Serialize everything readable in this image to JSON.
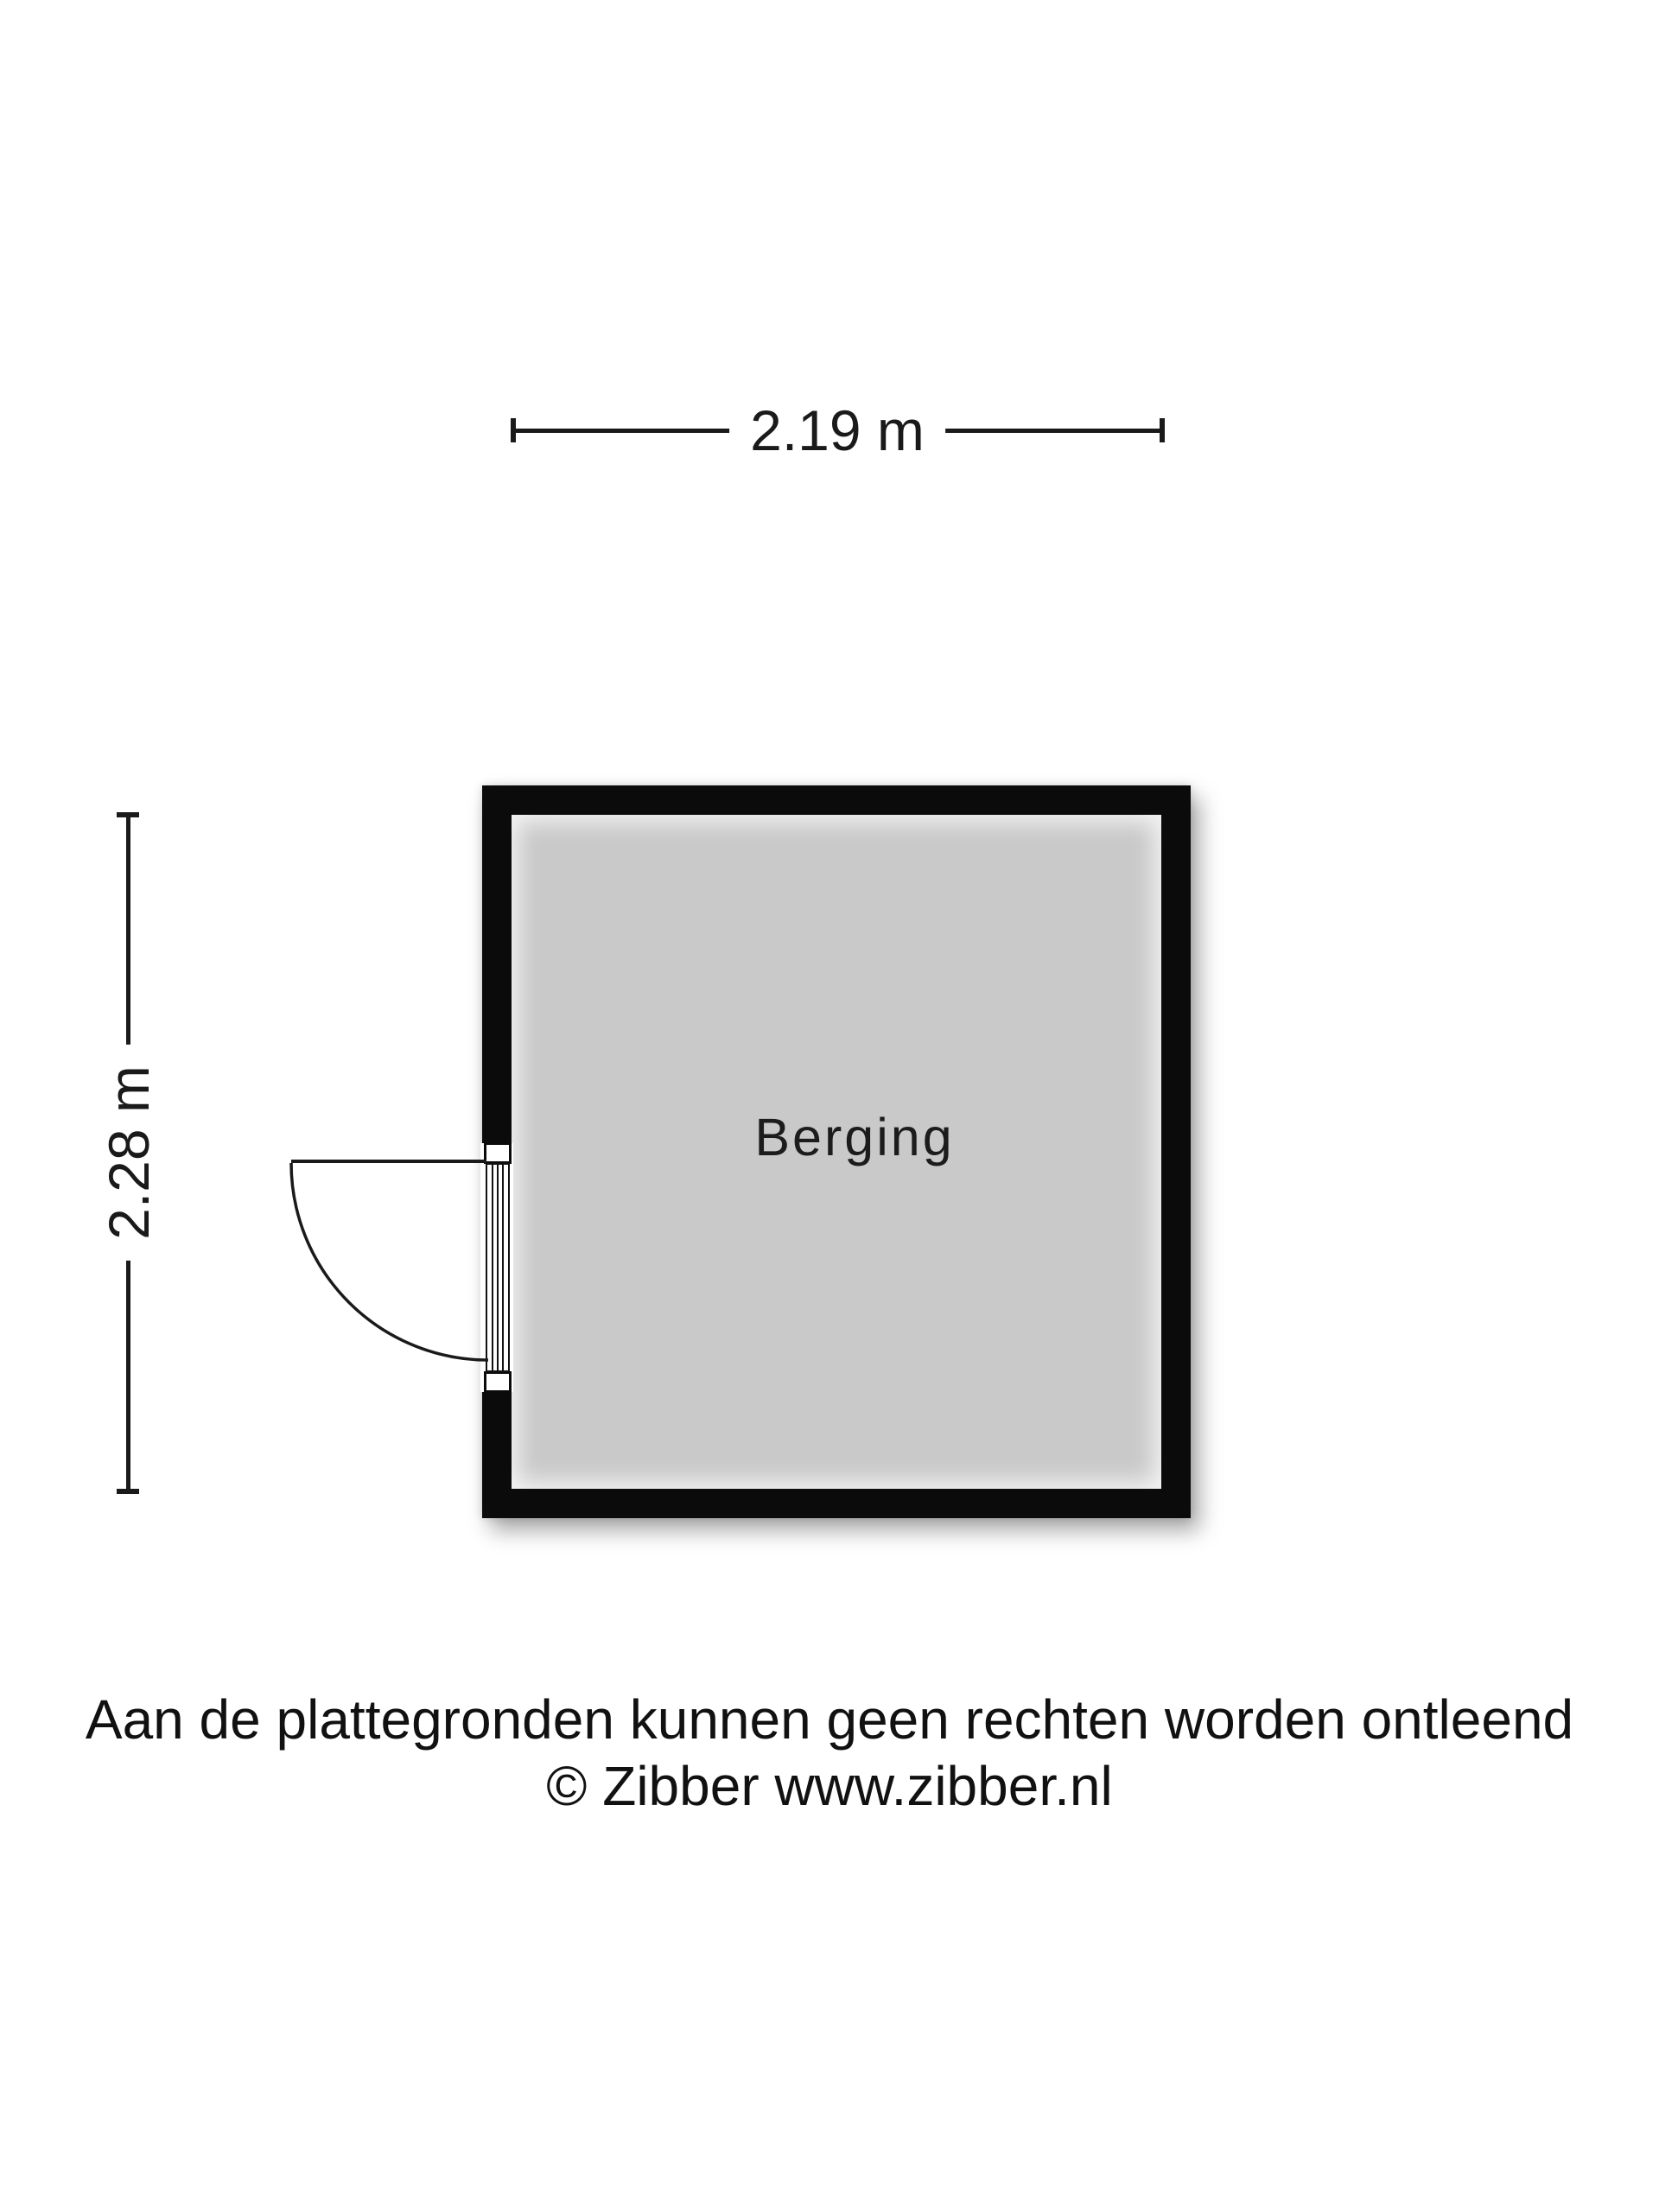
{
  "floorplan": {
    "room": {
      "label": "Berging"
    },
    "dimensions": {
      "width_label": "2.19 m",
      "height_label": "2.28 m"
    },
    "door": {
      "icon": "door-swing-icon",
      "type": "single-swing-door"
    },
    "colors": {
      "wall": "#0b0b0b",
      "floor": "#c9c9c9",
      "line": "#1a1a1a",
      "background": "#ffffff"
    }
  },
  "footer": {
    "disclaimer": "Aan de plattegronden kunnen geen rechten worden ontleend",
    "copyright": "© Zibber www.zibber.nl"
  }
}
